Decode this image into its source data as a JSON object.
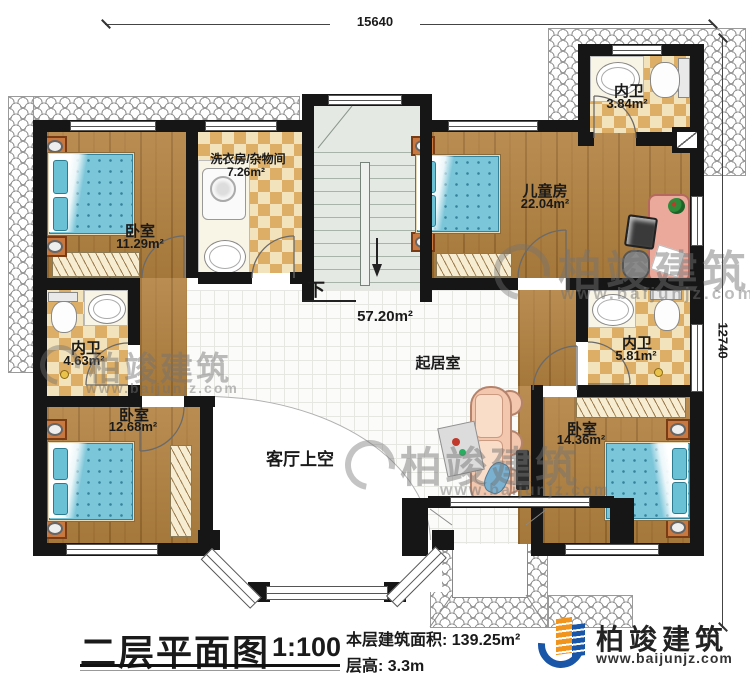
{
  "plan": {
    "dimension_top": "15640",
    "dimension_right": "12740",
    "stairs_down_label": "下"
  },
  "rooms": [
    {
      "name": "卧室",
      "area": "11.29m²"
    },
    {
      "name": "洗衣房/杂物间",
      "area": "7.26m²"
    },
    {
      "name": "儿童房",
      "area": "22.04m²"
    },
    {
      "name": "内卫",
      "area": "3.84m²"
    },
    {
      "name": "内卫",
      "area": "4.63m²"
    },
    {
      "name": "内卫",
      "area": "5.81m²"
    },
    {
      "name": "起居室",
      "area": "57.20m²"
    },
    {
      "name": "卧室",
      "area": "12.68m²"
    },
    {
      "name": "卧室",
      "area": "14.36m²"
    },
    {
      "name": "客厅上空",
      "area": ""
    }
  ],
  "title_block": {
    "plan_title": "二层平面图",
    "scale": "1:100",
    "floor_area": "本层建筑面积: 139.25m²",
    "floor_height": "层高: 3.3m"
  },
  "brand": {
    "name": "柏竣建筑",
    "website": "www.baijunjz.com"
  },
  "watermark": {
    "name": "柏竣建筑",
    "website": "www.baijunjz.com"
  }
}
